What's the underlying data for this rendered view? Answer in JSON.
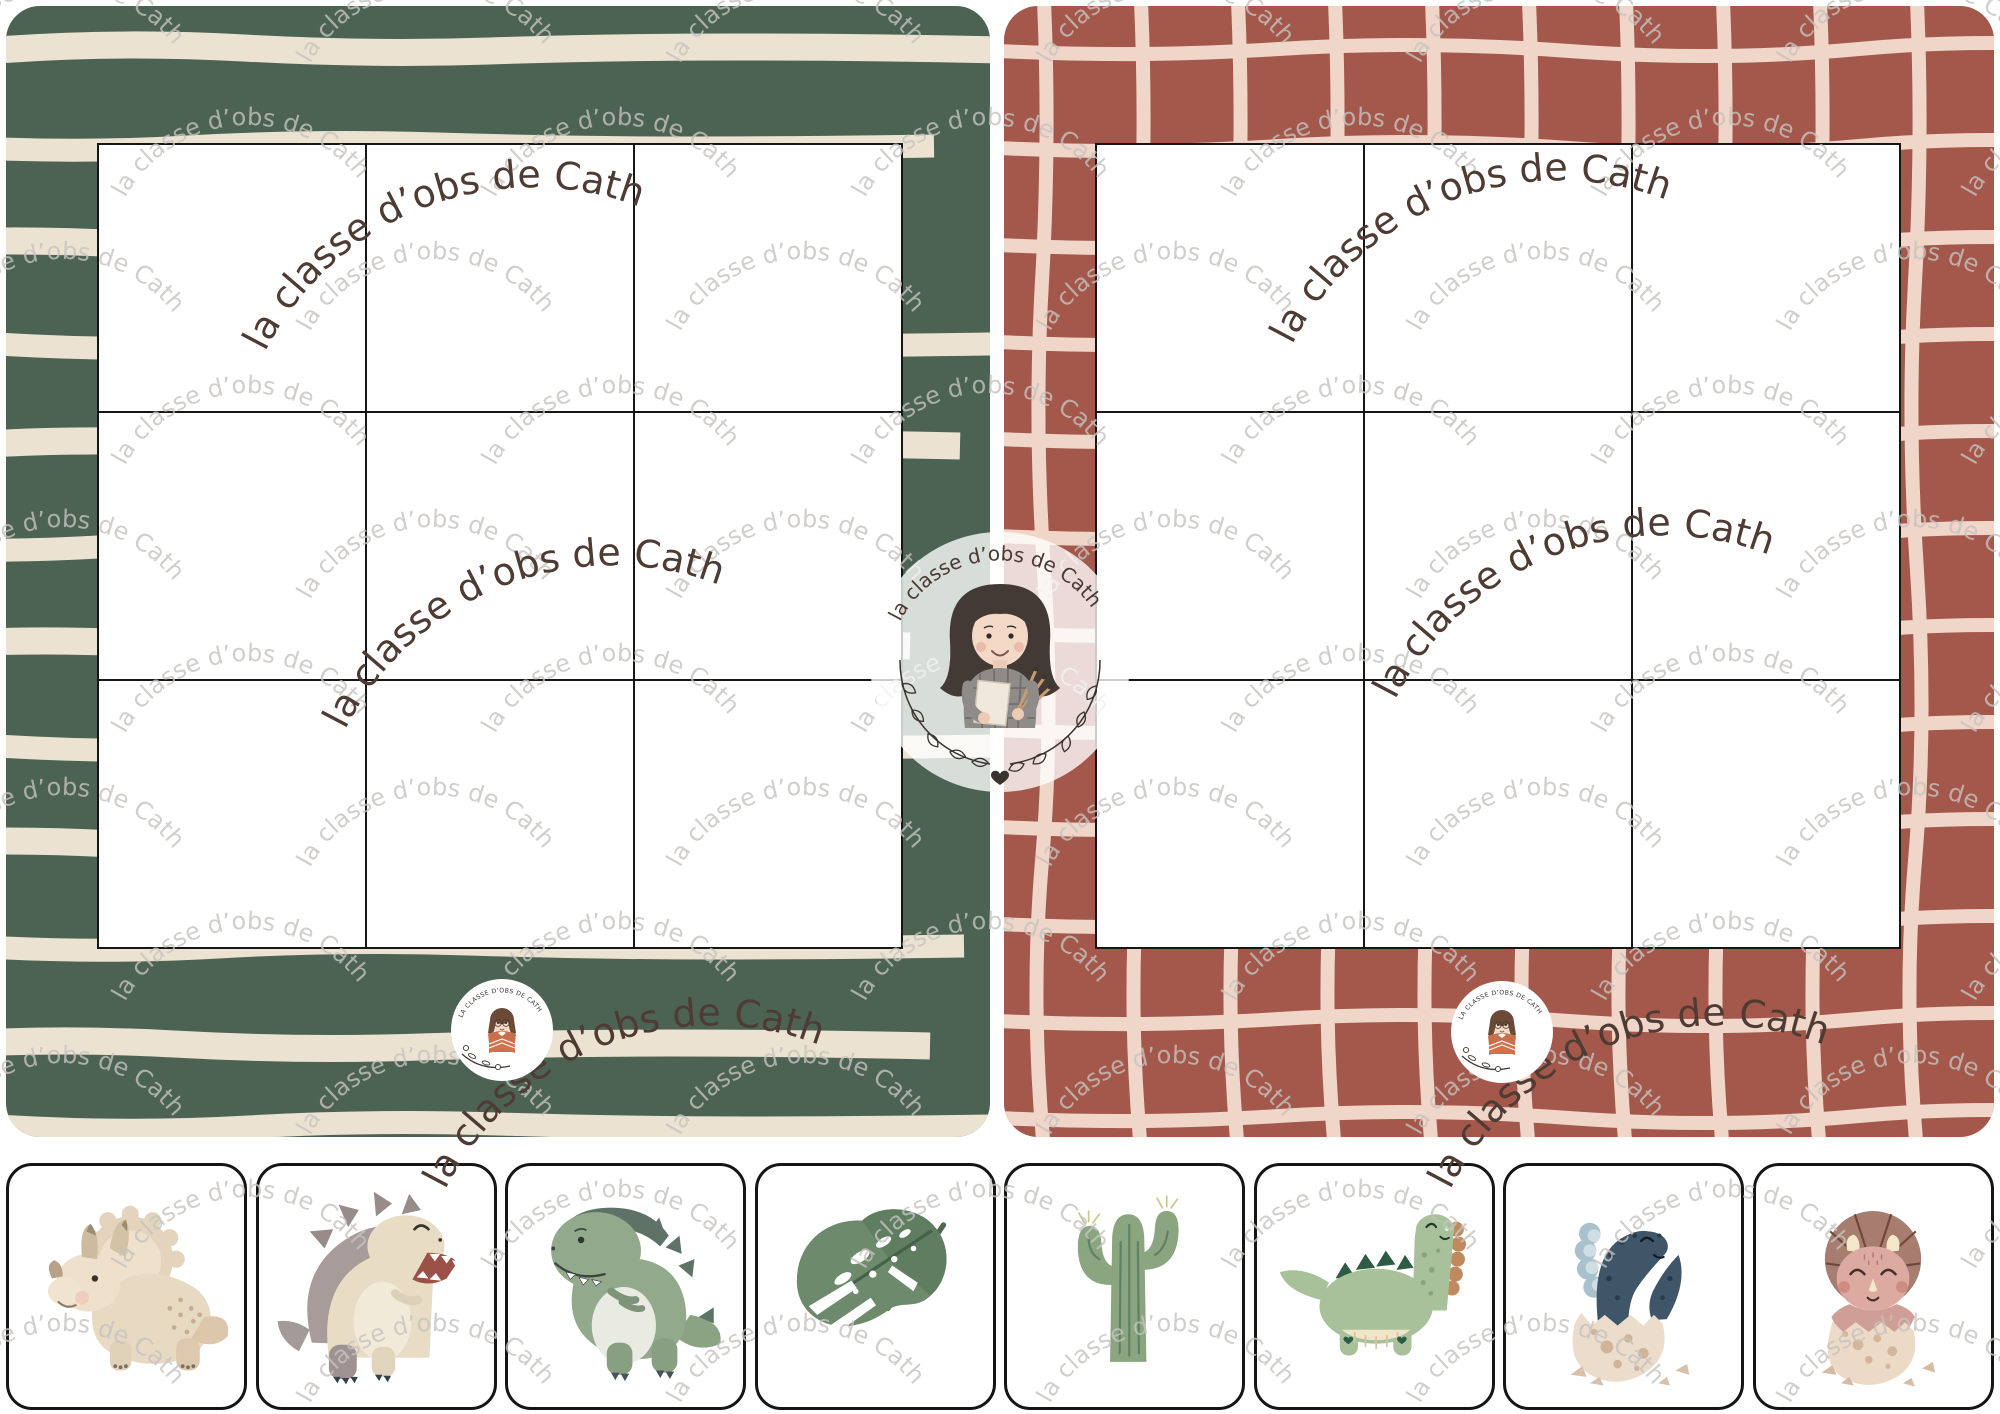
{
  "watermark": {
    "text": "la classe d’obs de Cath",
    "light_color": "#c6c3c0",
    "dark_color": "#4e3b34"
  },
  "center_logo": {
    "text": "la classe d’obs de Cath",
    "heart": "♥"
  },
  "badge_logo": {
    "text": "LA CLASSE D’OBS DE CATH"
  },
  "boards": [
    {
      "name": "striped-green-board",
      "bg": "#4c6353",
      "stripe_color": "#ece2d2",
      "grid": {
        "rows": 3,
        "cols": 3
      }
    },
    {
      "name": "checked-terracotta-board",
      "bg": "#a3584b",
      "line_color": "#f0d5c9",
      "grid": {
        "rows": 3,
        "cols": 3
      }
    }
  ],
  "cards": [
    {
      "label": "triceratops-beige"
    },
    {
      "label": "spiky-dino-beige"
    },
    {
      "label": "t-rex-green"
    },
    {
      "label": "monstera-leaf"
    },
    {
      "label": "cactus"
    },
    {
      "label": "brontosaurus-green"
    },
    {
      "label": "blue-dino-hatchling"
    },
    {
      "label": "pink-triceratops-hatchling"
    }
  ]
}
